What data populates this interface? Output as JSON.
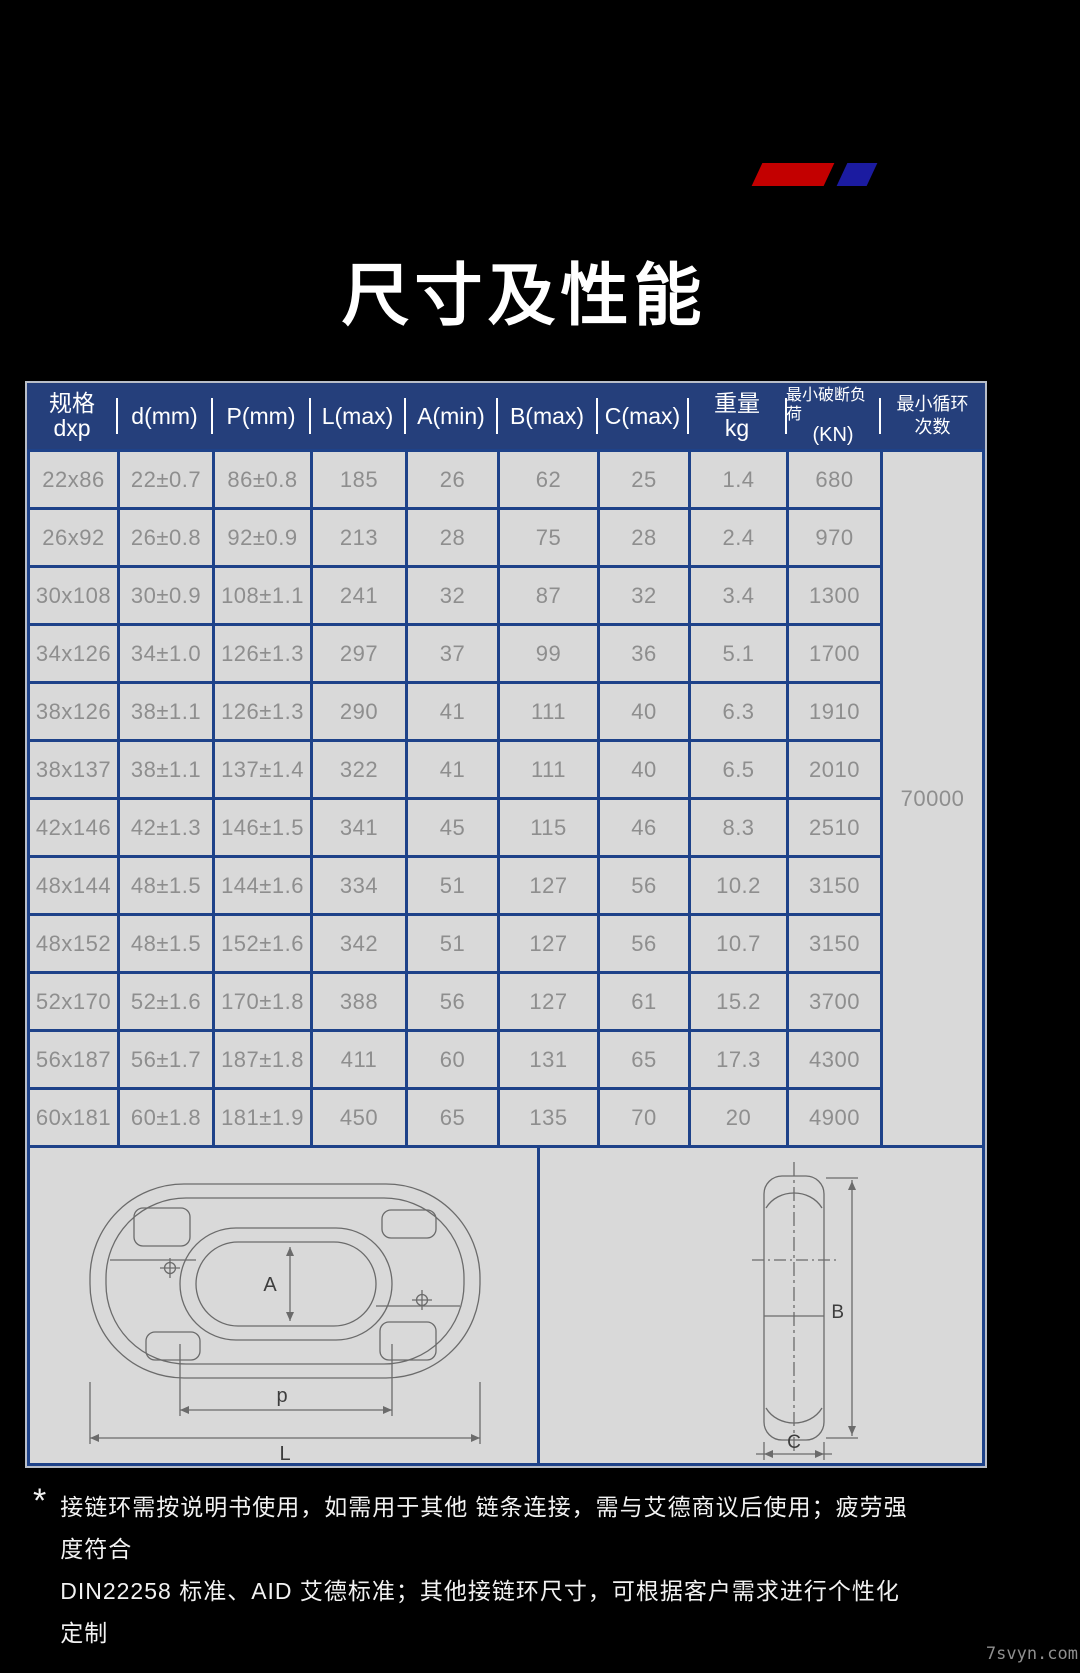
{
  "title": "尺寸及性能",
  "colors": {
    "accent_red": "#c30000",
    "accent_blue": "#1b1ba0",
    "header_bg": "#253f7b",
    "grid_line": "#1e4289",
    "cell_bg": "#d9d9d9",
    "cell_text": "#8e8e8e"
  },
  "table": {
    "headers": [
      {
        "line1": "规格",
        "line2": "dxp"
      },
      {
        "line1": "d(mm)",
        "line2": ""
      },
      {
        "line1": "P(mm)",
        "line2": ""
      },
      {
        "line1": "L(max)",
        "line2": ""
      },
      {
        "line1": "A(min)",
        "line2": ""
      },
      {
        "line1": "B(max)",
        "line2": ""
      },
      {
        "line1": "C(max)",
        "line2": ""
      },
      {
        "line1": "重量",
        "line2": "kg"
      },
      {
        "line1": "最小破断负荷",
        "line2": "(KN)"
      },
      {
        "line1": "最小循环",
        "line2": "次数"
      }
    ],
    "rows": [
      [
        "22x86",
        "22±0.7",
        "86±0.8",
        "185",
        "26",
        "62",
        "25",
        "1.4",
        "680"
      ],
      [
        "26x92",
        "26±0.8",
        "92±0.9",
        "213",
        "28",
        "75",
        "28",
        "2.4",
        "970"
      ],
      [
        "30x108",
        "30±0.9",
        "108±1.1",
        "241",
        "32",
        "87",
        "32",
        "3.4",
        "1300"
      ],
      [
        "34x126",
        "34±1.0",
        "126±1.3",
        "297",
        "37",
        "99",
        "36",
        "5.1",
        "1700"
      ],
      [
        "38x126",
        "38±1.1",
        "126±1.3",
        "290",
        "41",
        "111",
        "40",
        "6.3",
        "1910"
      ],
      [
        "38x137",
        "38±1.1",
        "137±1.4",
        "322",
        "41",
        "111",
        "40",
        "6.5",
        "2010"
      ],
      [
        "42x146",
        "42±1.3",
        "146±1.5",
        "341",
        "45",
        "115",
        "46",
        "8.3",
        "2510"
      ],
      [
        "48x144",
        "48±1.5",
        "144±1.6",
        "334",
        "51",
        "127",
        "56",
        "10.2",
        "3150"
      ],
      [
        "48x152",
        "48±1.5",
        "152±1.6",
        "342",
        "51",
        "127",
        "56",
        "10.7",
        "3150"
      ],
      [
        "52x170",
        "52±1.6",
        "170±1.8",
        "388",
        "56",
        "127",
        "61",
        "15.2",
        "3700"
      ],
      [
        "56x187",
        "56±1.7",
        "187±1.8",
        "411",
        "60",
        "131",
        "65",
        "17.3",
        "4300"
      ],
      [
        "60x181",
        "60±1.8",
        "181±1.9",
        "450",
        "65",
        "135",
        "70",
        "20",
        "4900"
      ]
    ],
    "cycle_value": "70000"
  },
  "diagram": {
    "labels": {
      "a": "A",
      "p": "p",
      "l": "L",
      "b": "B",
      "c": "C"
    }
  },
  "footnote": {
    "star": "*",
    "line1": "接链环需按说明书使用，如需用于其他 链条连接，需与艾德商议后使用；疲劳强 度符合",
    "line2": "DIN22258 标准、AID 艾德标准；其他接链环尺寸，可根据客户需求进行个性化定制"
  },
  "watermark": "7svyn.com"
}
